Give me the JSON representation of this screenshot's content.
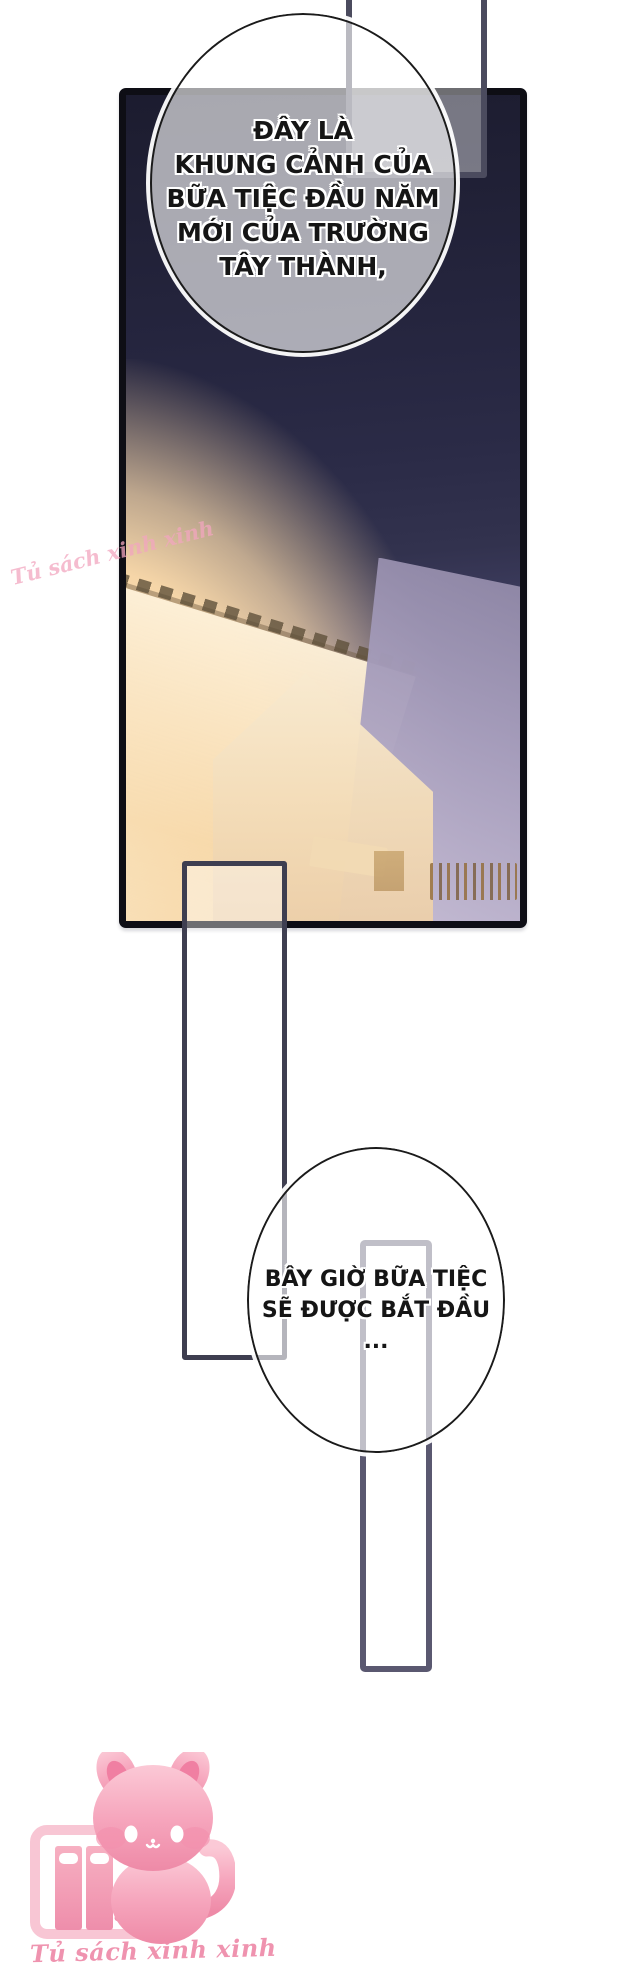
{
  "comic": {
    "bubble1": {
      "lines": [
        "ĐÂY LÀ",
        "KHUNG CẢNH CỦA",
        "BỮA TIỆC ĐẦU NĂM",
        "MỚI CỦA TRƯỜNG",
        "TÂY THÀNH,"
      ]
    },
    "bubble2": {
      "lines": [
        "BÂY GIỜ BỮA TIỆC",
        "SẼ ĐƯỢC BẮT ĐẦU",
        "..."
      ]
    }
  },
  "watermark": {
    "side": "Tủ sách xinh xinh",
    "bottom": "Tủ sách xinh xinh"
  },
  "mascot": {
    "icon": "pink-cat-with-bookshelf-logo"
  },
  "colors": {
    "page_bg": "#ffffff",
    "panel_border": "#0e0e15",
    "sky_top": "#1c1c2f",
    "sky_mid": "#32324e",
    "sky_bottom_lavender": "#b3aac4",
    "warm_glow": "#f6d6a8",
    "frame_stroke": "#4b4b5e",
    "bubble_fill": "rgba(255,255,255,0.62)",
    "bubble_stroke": "#1b1b1b",
    "watermark_pink": "#ef93af",
    "mascot_pink": "#f4a0b8"
  }
}
